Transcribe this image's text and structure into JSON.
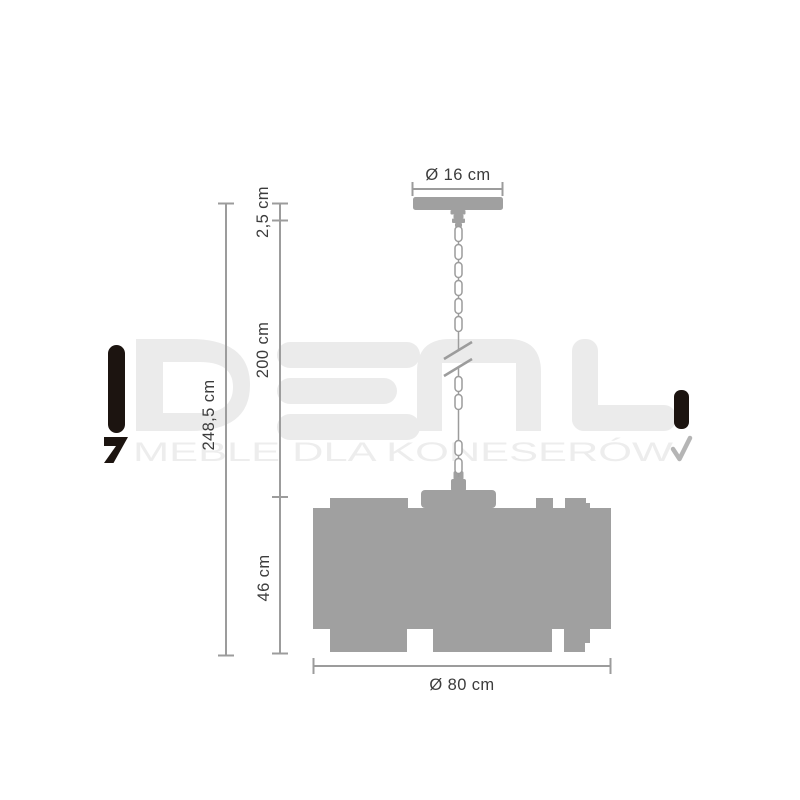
{
  "product_diagram": {
    "dimensions": {
      "canopy_diameter": "Ø 16 cm",
      "canopy_height": "2,5 cm",
      "chain_length": "200 cm",
      "total_height": "248,5 cm",
      "shade_height": "46 cm",
      "shade_diameter": "Ø 80 cm"
    },
    "colors": {
      "line": "#9c9c9c",
      "silhouette": "#a0a0a0",
      "label_text": "#3c3c3c",
      "background": "#ffffff"
    }
  },
  "watermark": {
    "brand": "IDEAL",
    "tagline": "MEBLE DLA KONESERÓW",
    "colors": {
      "letters": "#ebebeb",
      "tagline_text": "#ededed",
      "accent_black": "#1c1410",
      "check_gray": "#b5b5b5"
    }
  }
}
